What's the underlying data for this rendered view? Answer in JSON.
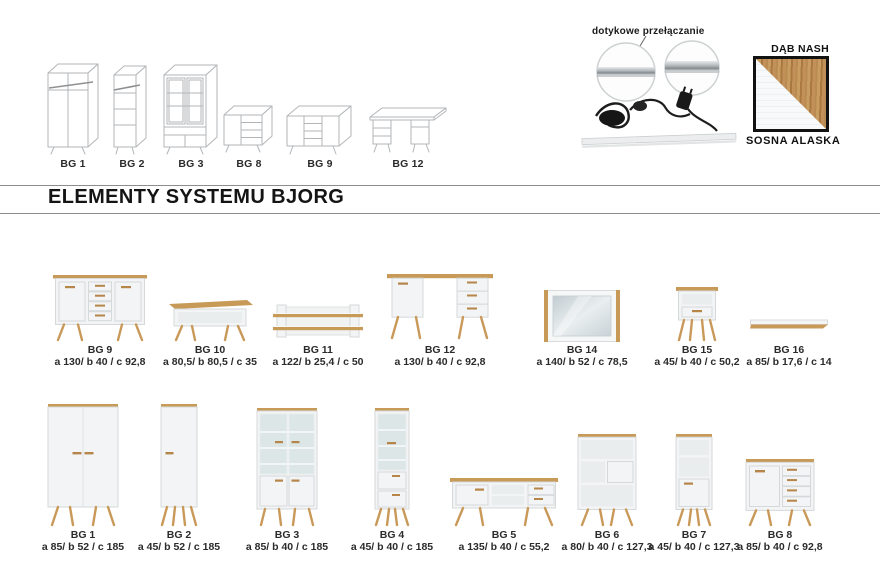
{
  "heading": {
    "title": "ELEMENTY SYSTEMU BJORG"
  },
  "led": {
    "caption": "dotykowe przełączanie"
  },
  "swatch": {
    "top_label": "DĄB NASH",
    "bottom_label": "SOSNA ALASKA",
    "wood_color": "#c2915a",
    "white_color": "#f5f7f8"
  },
  "sketches": [
    {
      "label": "BG 1"
    },
    {
      "label": "BG 2"
    },
    {
      "label": "BG 3"
    },
    {
      "label": "BG 8"
    },
    {
      "label": "BG 9"
    },
    {
      "label": "BG 12"
    }
  ],
  "row1": [
    {
      "name": "BG 9",
      "dims": "a 130/ b 40 / c 92,8"
    },
    {
      "name": "BG 10",
      "dims": "a 80,5/ b 80,5 / c 35"
    },
    {
      "name": "BG 11",
      "dims": "a 122/ b 25,4 / c 50"
    },
    {
      "name": "BG 12",
      "dims": "a 130/ b 40 / c 92,8"
    },
    {
      "name": "BG 14",
      "dims": "a 140/ b 52 / c 78,5"
    },
    {
      "name": "BG 15",
      "dims": "a 45/ b 40 / c 50,2"
    },
    {
      "name": "BG 16",
      "dims": "a 85/ b 17,6 / c 14"
    }
  ],
  "row2": [
    {
      "name": "BG 1",
      "dims": "a 85/ b 52 / c 185"
    },
    {
      "name": "BG 2",
      "dims": "a 45/ b 52 / c 185"
    },
    {
      "name": "BG 3",
      "dims": "a 85/ b 40 / c 185"
    },
    {
      "name": "BG 4",
      "dims": "a 45/ b 40 / c 185"
    },
    {
      "name": "BG 5",
      "dims": "a 135/ b 40 / c 55,2"
    },
    {
      "name": "BG 6",
      "dims": "a 80/ b 40 / c 127,3"
    },
    {
      "name": "BG 7",
      "dims": "a 45/ b 40 / c 127,3"
    },
    {
      "name": "BG 8",
      "dims": "a 85/ b 40 / c 92,8"
    }
  ],
  "colors": {
    "wood": "#c79a58",
    "body": "#f3f4f5",
    "text": "#2b2b2b"
  }
}
